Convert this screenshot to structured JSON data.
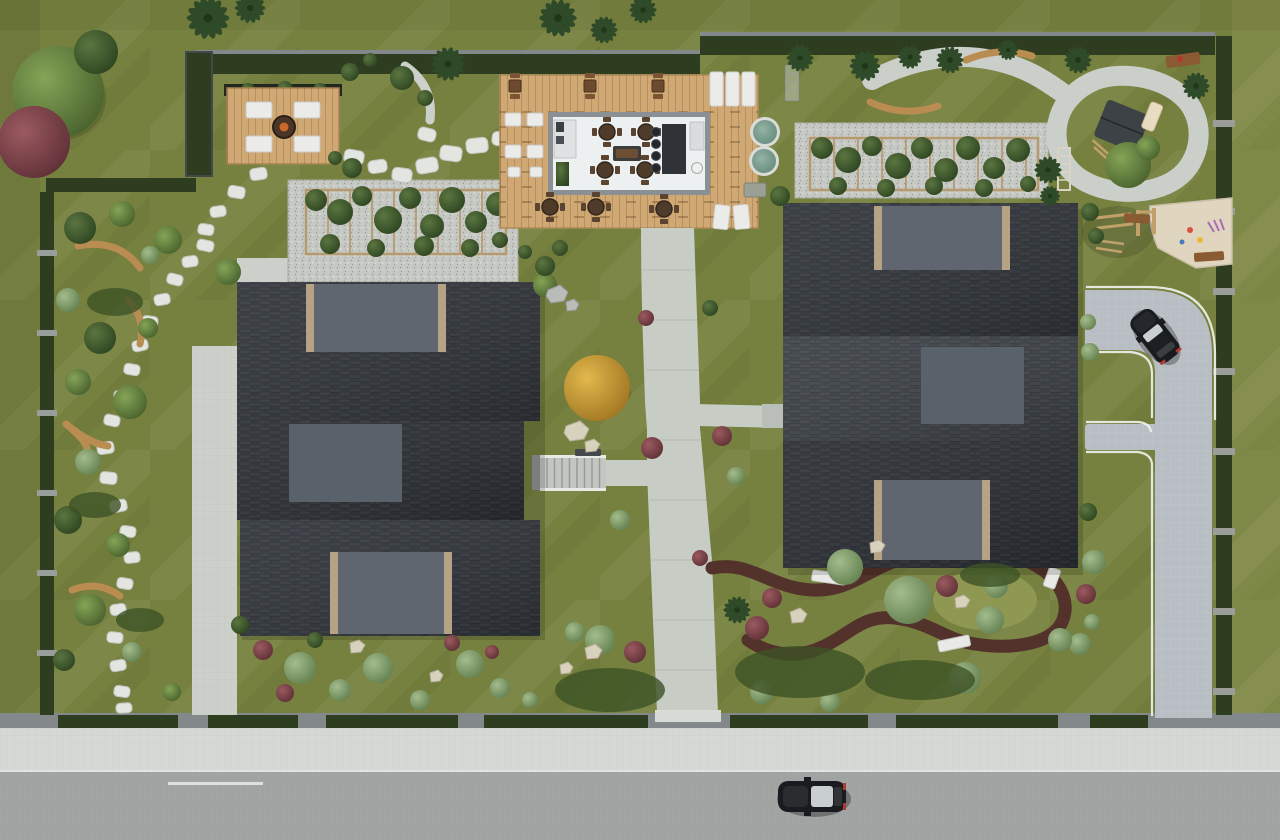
{
  "meta": {
    "scene": "Aerial top-down 3D architectural site plan render of a residential complex",
    "view": "top-down",
    "no_visible_text": true
  },
  "palette": {
    "grass_lawn": "#76813f",
    "grass_shade": "rgba(30,40,10,0.08)",
    "grass_light": "rgba(255,255,190,0.07)",
    "hedge": "#2e3d1f",
    "hedge_wall": "#83888a",
    "border_post": "#9a9d99",
    "stone": "#e3e5e0",
    "stone_edge": "#bfc2bb",
    "apron": "#ccd0ca",
    "gravel": "#c6c9c3",
    "walkway": "#c7ccc5",
    "sidewalk": "#d6d8d5",
    "street": "#a0a4a3",
    "driveway": "#b8bec4",
    "white_line": "#f1f3ef",
    "road_mark": "rgba(255,255,255,0.65)",
    "deck": "#cfa873",
    "deck_edge": "#a98253",
    "pergola_beam": "#b59a6f",
    "vine": "#3c4e2a",
    "vine_light": "#546e38",
    "roof_dark": "#2e3339",
    "roof_mid": "#3a3f45",
    "roof_deep": "#282c31",
    "panel": "#5f666f",
    "panel_alt": "#59616b",
    "trim": "#b6a386",
    "club_wall": "#8b9095",
    "club_floor": "#edf0f0",
    "bar": "#2f3338",
    "table_wood": "#4f3b2a",
    "chair_wood": "#5a442f",
    "furniture_white": "#ebece9",
    "furniture_brown": "#6b4a2f",
    "bench_wood": "#b98c52",
    "bench_white": "#e9eae7",
    "pool": "#7fa392",
    "pool_rim": "#dadcd8",
    "mulch": "#53322b",
    "meadow": "#8e9853",
    "sand": "#e0d6bf",
    "play_house": "#3d4246",
    "slide": "#e8dcc3",
    "fire_pit": "#4a3526",
    "fire_accent": "#c96a2a",
    "car_body": "#191b1e",
    "car_glass": "#c9ced1",
    "car_tail": "#b23830",
    "rock_beige": "#d8d1bd",
    "rock_gray": "#b9bcb8",
    "groundcover": "#3d5226",
    "palm": "#2f4a28",
    "tree_green_hi": "#86a457",
    "tree_green_lo": "#47602c",
    "tree_dark_hi": "#5a7540",
    "tree_dark_lo": "#2d4420",
    "tree_sage_hi": "#a3bc8d",
    "tree_sage_lo": "#637f4e",
    "tree_red_hi": "#9b5a60",
    "tree_red_lo": "#5e2f36",
    "tree_yellow_hi": "#e2b84d",
    "tree_yellow_lo": "#9e7421"
  },
  "features": {
    "buildings": [
      {
        "name": "west residential cluster",
        "units": 3,
        "roof": "dark shingle with gray skylight panels"
      },
      {
        "name": "east residential cluster",
        "units": 3,
        "roof": "dark shingle with gray skylight panels"
      }
    ],
    "amenities": [
      "clubhouse pavilion with dining tables and bar",
      "timber sun deck with loungers",
      "fire-pit lounge deck",
      "two round spa pools",
      "two vine-covered pergola courts on gravel",
      "children playground with play house, slide, loop path and sand pit",
      "outdoor fitness corner",
      "zen stepping-stone garden with curved benches",
      "mulch walking-trail garden with white benches"
    ],
    "circulation": [
      "perimeter hedge fence with posts",
      "street with sidewalk at bottom",
      "paver driveway with turning car at right",
      "central concrete walkway with garden stairs",
      "looping playground path",
      "stepping-stone trails"
    ],
    "vehicles": [
      {
        "name": "sedan driving on street",
        "color_key": "car_body"
      },
      {
        "name": "suv turning on driveway",
        "color_key": "car_body"
      }
    ]
  }
}
